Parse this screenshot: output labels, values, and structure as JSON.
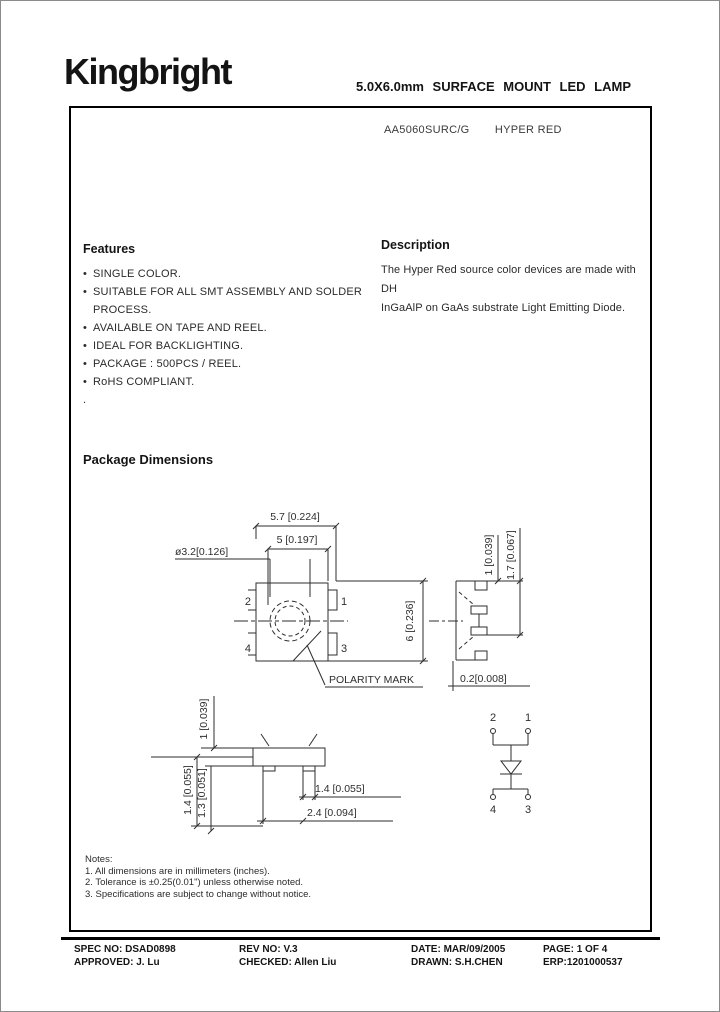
{
  "header": {
    "logo": "Kingbright",
    "title": "5.0X6.0mm SURFACE MOUNT LED LAMP"
  },
  "part": {
    "number": "AA5060SURC/G",
    "color_name": "HYPER RED"
  },
  "features": {
    "heading": "Features",
    "items": [
      "SINGLE COLOR.",
      "SUITABLE FOR ALL SMT ASSEMBLY AND SOLDER PROCESS.",
      "AVAILABLE ON TAPE AND REEL.",
      "IDEAL FOR BACKLIGHTING.",
      "PACKAGE : 500PCS / REEL.",
      "RoHS COMPLIANT."
    ],
    "trailing": "."
  },
  "description": {
    "heading": "Description",
    "lines": [
      "The  Hyper Red source  color devices are made with  DH",
      "InGaAlP on GaAs substrate Light  Emitting Diode."
    ]
  },
  "package_dimensions": {
    "heading": "Package Dimensions"
  },
  "drawing": {
    "top_view": {
      "dim_outer_width": "5.7  [0.224]",
      "dim_inner_width": "5  [0.197]",
      "dim_lens": "ø3.2[0.126]",
      "dim_height": "6  [0.236]",
      "pin1": "1",
      "pin2": "2",
      "pin3": "3",
      "pin4": "4",
      "polarity_label": "POLARITY  MARK"
    },
    "side_view": {
      "dim_tab": "1 [0.039]",
      "dim_body": "1.7  [0.067]",
      "dim_standoff": "0.2[0.008]"
    },
    "front_view": {
      "dim_tab_height": "1  [0.039]",
      "dim_total_height": "1.4  [0.055]",
      "dim_body_height": "1.3  [0.051]",
      "dim_lead": "1.4  [0.055]",
      "dim_lead_pitch": "2.4  [0.094]"
    },
    "schematic": {
      "pin1": "1",
      "pin2": "2",
      "pin3": "3",
      "pin4": "4"
    }
  },
  "notes": {
    "heading": "Notes:",
    "items": [
      "1. All dimensions are in millimeters (inches).",
      "2. Tolerance is ±0.25(0.01\") unless otherwise noted.",
      "3. Specifications are subject  to change without notice."
    ]
  },
  "footer": {
    "spec_no": "SPEC NO: DSAD0898",
    "approved": "APPROVED: J. Lu",
    "rev_no": "REV NO: V.3",
    "checked": "CHECKED: Allen Liu",
    "date": "DATE: MAR/09/2005",
    "drawn": "DRAWN: S.H.CHEN",
    "page": "PAGE:  1 OF 4",
    "erp": "ERP:1201000537"
  }
}
